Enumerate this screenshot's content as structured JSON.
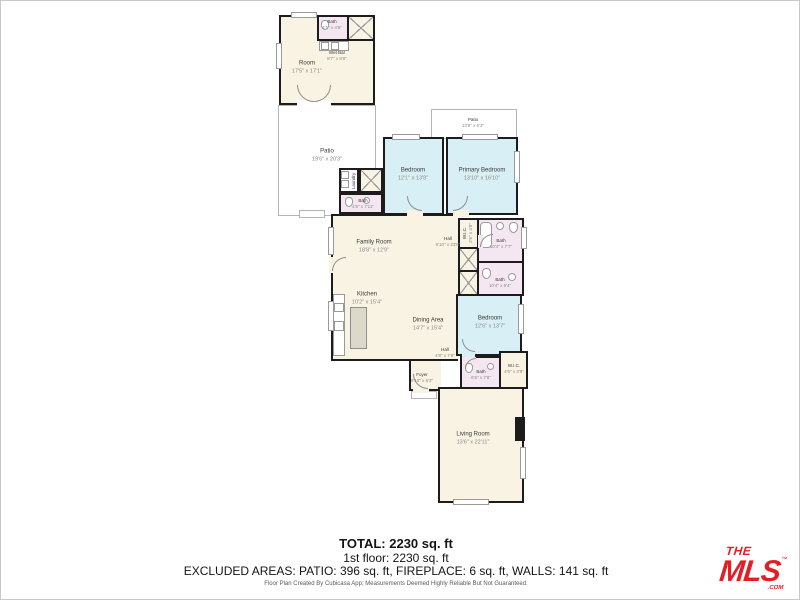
{
  "colors": {
    "wall": "#1c1c1c",
    "room_beige": "#f8f3e2",
    "bedroom_cyan": "#d8eff5",
    "bath_pink": "#f4e7f1",
    "patio_outline": "#b5b5b5",
    "logo_red": "#e31f26"
  },
  "rooms": [
    {
      "name": "Room",
      "dims": "17'5\" x 17'1\""
    },
    {
      "name": "Bath",
      "dims": "4'1\" x 4'6\""
    },
    {
      "name": "Wet Bar",
      "dims": "8'7\" x 9'8\""
    },
    {
      "name": "Patio",
      "dims": "19'6\" x 20'3\""
    },
    {
      "name": "Patio",
      "dims": "13'8\" x 5'3\""
    },
    {
      "name": "Bedroom",
      "dims": "12'1\" x 13'8\""
    },
    {
      "name": "Primary Bedroom",
      "dims": "13'10\" x 16'10\""
    },
    {
      "name": "Laundry",
      "dims": ""
    },
    {
      "name": "Bath",
      "dims": "4'5\" x 7'11\""
    },
    {
      "name": "Family Room",
      "dims": "18'8\" x 12'9\""
    },
    {
      "name": "Hall",
      "dims": "6'10\" x 23'8\""
    },
    {
      "name": "W.I.C.",
      "dims": "2'6\" x 4'8\""
    },
    {
      "name": "Bath",
      "dims": "10'4\" x 7'7\""
    },
    {
      "name": "Bath",
      "dims": "10'4\" x 6'4\""
    },
    {
      "name": "Kitchen",
      "dims": "10'2\" x 15'4\""
    },
    {
      "name": "Dining Area",
      "dims": "14'7\" x 15'4\""
    },
    {
      "name": "Bedroom",
      "dims": "12'6\" x 13'7\""
    },
    {
      "name": "Hall",
      "dims": "4'8\" x 7'8\""
    },
    {
      "name": "Bath",
      "dims": "6'5\" x 7'8\""
    },
    {
      "name": "W.I.C.",
      "dims": "4'5\" x 3'9\""
    },
    {
      "name": "Foyer",
      "dims": "9'10\" x 6'3\""
    },
    {
      "name": "Living Room",
      "dims": "13'6\" x 22'11\""
    }
  ],
  "footer": {
    "total": "TOTAL: 2230 sq. ft",
    "floor": "1st floor: 2230 sq. ft",
    "excluded": "EXCLUDED AREAS: PATIO: 396 sq. ft, FIREPLACE: 6 sq. ft, WALLS: 141 sq. ft",
    "disclaimer": "Floor Plan Created By Cubicasa App; Measurements Deemed Highly Reliable But Not Guaranteed."
  },
  "logo": {
    "the": "THE",
    "mls": "MLS",
    "tm": "™",
    "com": ".COM"
  }
}
